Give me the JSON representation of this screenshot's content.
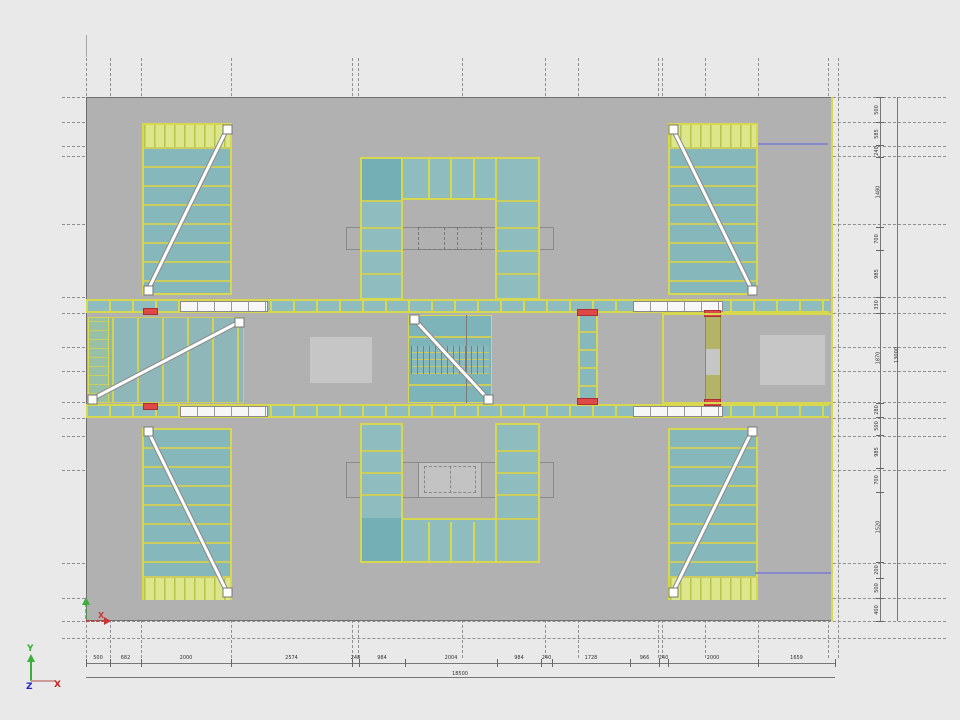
{
  "axis_gizmo": {
    "x": "X",
    "y": "Y",
    "z": "Z"
  },
  "ucs_marker": {
    "x": "X"
  },
  "dims_bottom": {
    "total": "18500",
    "values": [
      "500",
      "682",
      "2000",
      "2574",
      "248",
      "984",
      "2004",
      "984",
      "240",
      "1728",
      "966",
      "240",
      "2000",
      "1659"
    ]
  },
  "dims_right": {
    "total": "13000",
    "values": [
      "500",
      "585",
      "240",
      "1480",
      "700",
      "985",
      "330",
      "1870",
      "280",
      "500",
      "985",
      "700",
      "1520",
      "200",
      "500",
      "400"
    ]
  },
  "colors": {
    "slab_gray": "#b1b1b1",
    "room_teal": "#8fbcbf",
    "accent_yellow": "#d8d84e",
    "landing_green": "#dce78c",
    "door_red": "#e04848",
    "link_purple": "#8888cc",
    "axis_x_red": "#cc2222",
    "axis_y_green": "#2db32d",
    "axis_z_blue": "#2222cc"
  }
}
